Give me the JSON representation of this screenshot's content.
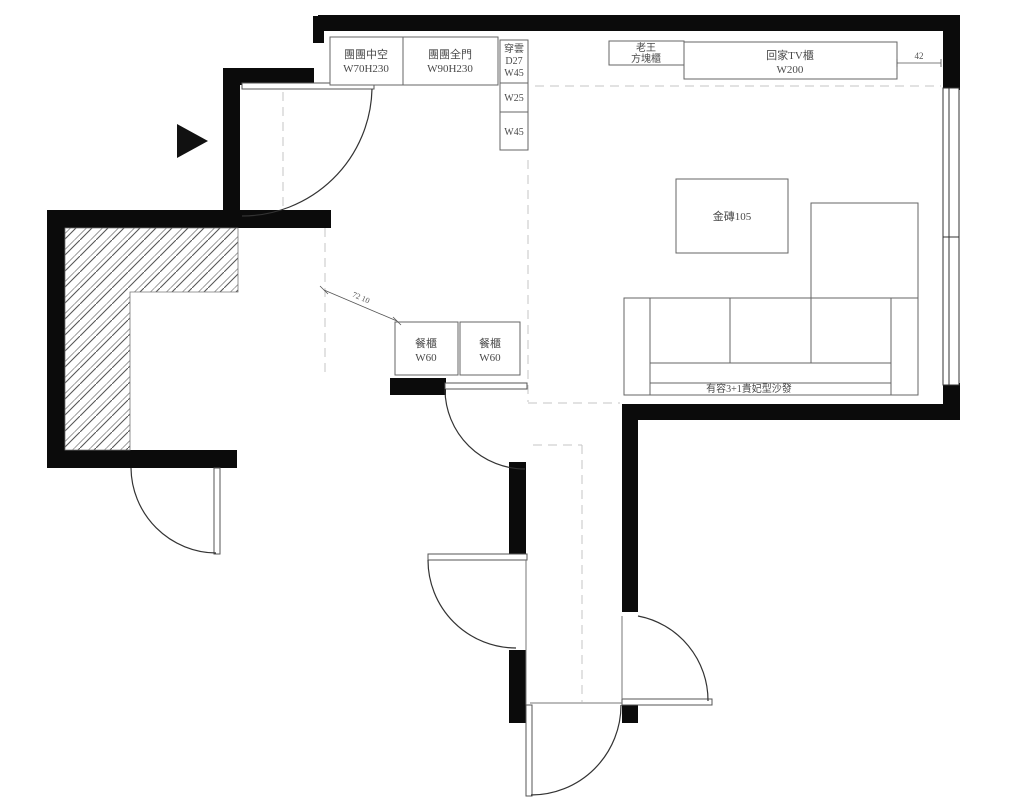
{
  "plan": {
    "type": "apartment-floor-plan",
    "colors": {
      "wall": "#0b0b0b",
      "line": "#666666",
      "dash": "#c4c4c4",
      "text": "#4a4a4a",
      "bg": "#ffffff"
    },
    "cabinets": {
      "hollow": {
        "name": "團團中空",
        "size": "W70H230"
      },
      "full_door": {
        "name": "團團全門",
        "size": "W90H230"
      },
      "chuanyun": {
        "name": "穿雲",
        "depth": "D27",
        "width": "W45"
      },
      "w25": "W25",
      "w45": "W45",
      "laowang": {
        "name": "老王",
        "type": "方塊櫃"
      },
      "tv": {
        "name": "回家TV櫃",
        "size": "W200"
      },
      "dining1": {
        "name": "餐櫃",
        "size": "W60"
      },
      "dining2": {
        "name": "餐櫃",
        "size": "W60"
      }
    },
    "furniture": {
      "coffee_table": "金磚105",
      "sofa": "有容3+1貴妃型沙發"
    },
    "dimensions": {
      "tv_gap": "42",
      "dining_diag": "72 10"
    }
  }
}
